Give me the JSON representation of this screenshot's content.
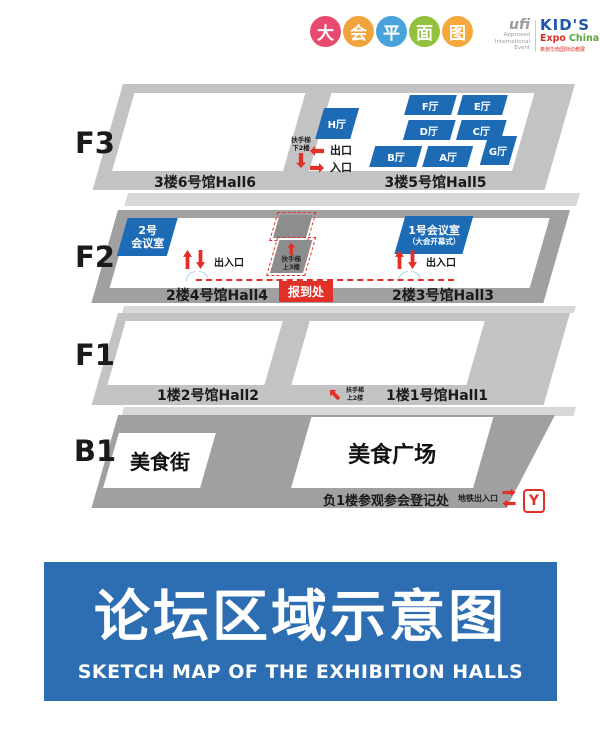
{
  "header": {
    "title_circles": [
      {
        "char": "大",
        "color": "#e8496e"
      },
      {
        "char": "会",
        "color": "#f0a43c"
      },
      {
        "char": "平",
        "color": "#47a3d9"
      },
      {
        "char": "面",
        "color": "#93c13d"
      },
      {
        "char": "图",
        "color": "#f5a93c"
      }
    ],
    "ufi_logo": {
      "brand": "ufi",
      "line1": "Approved",
      "line2": "International",
      "line3": "Event"
    },
    "kids_logo": {
      "title": "KID'S",
      "expo": "Expo",
      "china": "China",
      "caption": "奥驰华南国际幼教展"
    }
  },
  "f3": {
    "label": "F3",
    "mini_halls": [
      "H厅",
      "F厅",
      "E厅",
      "D厅",
      "C厅",
      "B厅",
      "A厅",
      "G厅"
    ],
    "escalator_line1": "扶手梯",
    "escalator_line2": "下2楼",
    "exit_label": "出口",
    "entrance_label": "入口",
    "hall6_label": "3楼6号馆Hall6",
    "hall5_label": "3楼5号馆Hall5"
  },
  "f2": {
    "label": "F2",
    "room2_line1": "2号",
    "room2_line2": "会议室",
    "room1_line1": "1号会议室",
    "room1_line2": "（大会开幕式）",
    "escalator_line1": "扶手梯",
    "escalator_line2": "上3楼",
    "gate_left_label": "出入口",
    "gate_right_label": "出入口",
    "checkin_label": "报到处",
    "hall4_label": "2楼4号馆Hall4",
    "hall3_label": "2楼3号馆Hall3"
  },
  "f1": {
    "label": "F1",
    "escalator_line1": "扶手梯",
    "escalator_line2": "上2楼",
    "hall2_label": "1楼2号馆Hall2",
    "hall1_label": "1楼1号馆Hall1"
  },
  "b1": {
    "label": "B1",
    "food_street_label": "美食街",
    "food_plaza_label": "美食广场",
    "registration_label": "负1楼参观参会登记处",
    "metro_label": "地铁出入口",
    "metro_logo_letter": "Y"
  },
  "banner": {
    "title": "论坛区域示意图",
    "subtitle": "SKETCH MAP OF THE EXHIBITION HALLS"
  },
  "colors": {
    "hall_blue": "#1d6bb5",
    "accent_red": "#e23028",
    "banner_blue": "#2d6db2",
    "light_gray": "#c3c3c3",
    "dark_gray": "#a0a0a0"
  }
}
